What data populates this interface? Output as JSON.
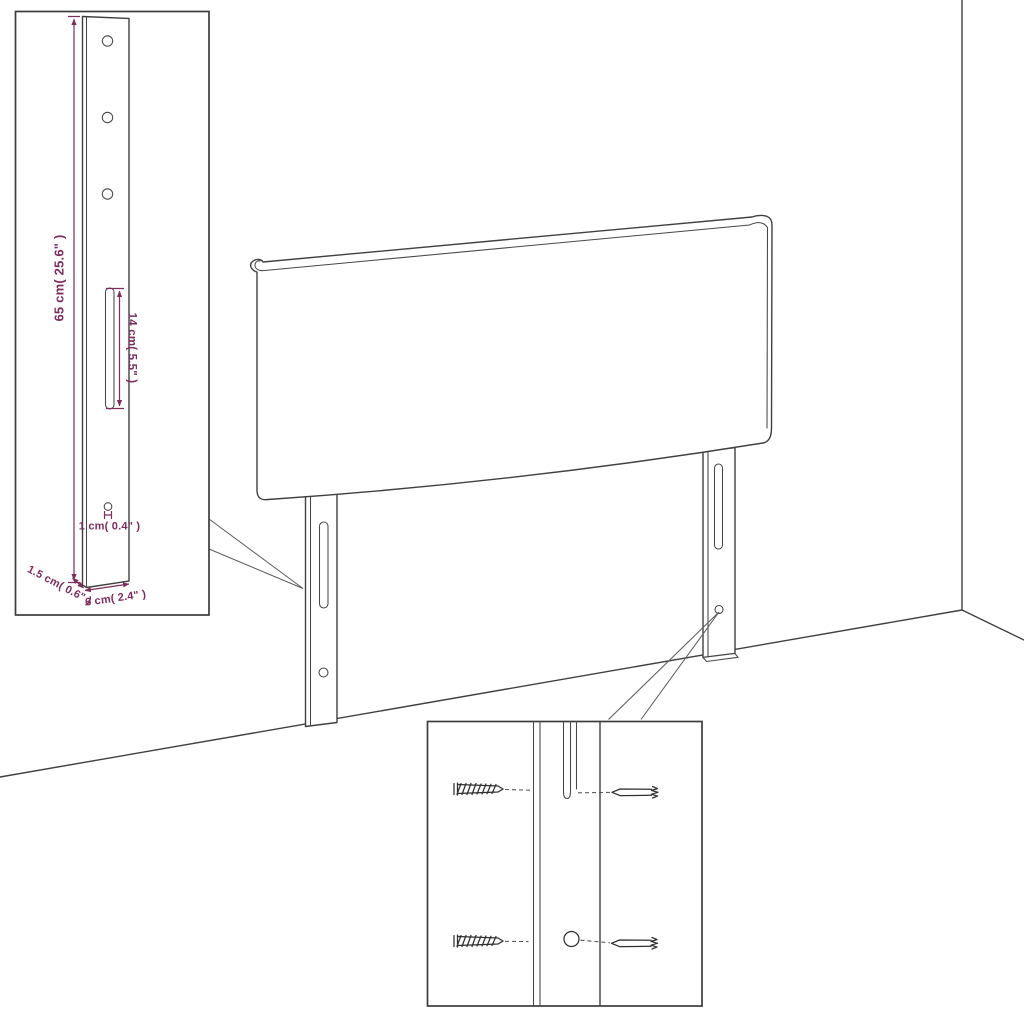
{
  "diagram": {
    "background": "#ffffff",
    "line_color": "#404040",
    "dimension_color": "#7d2c5c",
    "leg_detail_inset": {
      "dim_height": "65 cm( 25.6\" )",
      "dim_slot": "14 cm( 5.5\" )",
      "dim_hole": "1 cm( 0.4\" )",
      "dim_thickness": "1.5 cm( 0.6\" )",
      "dim_width": "6 cm( 2.4\" )"
    }
  }
}
